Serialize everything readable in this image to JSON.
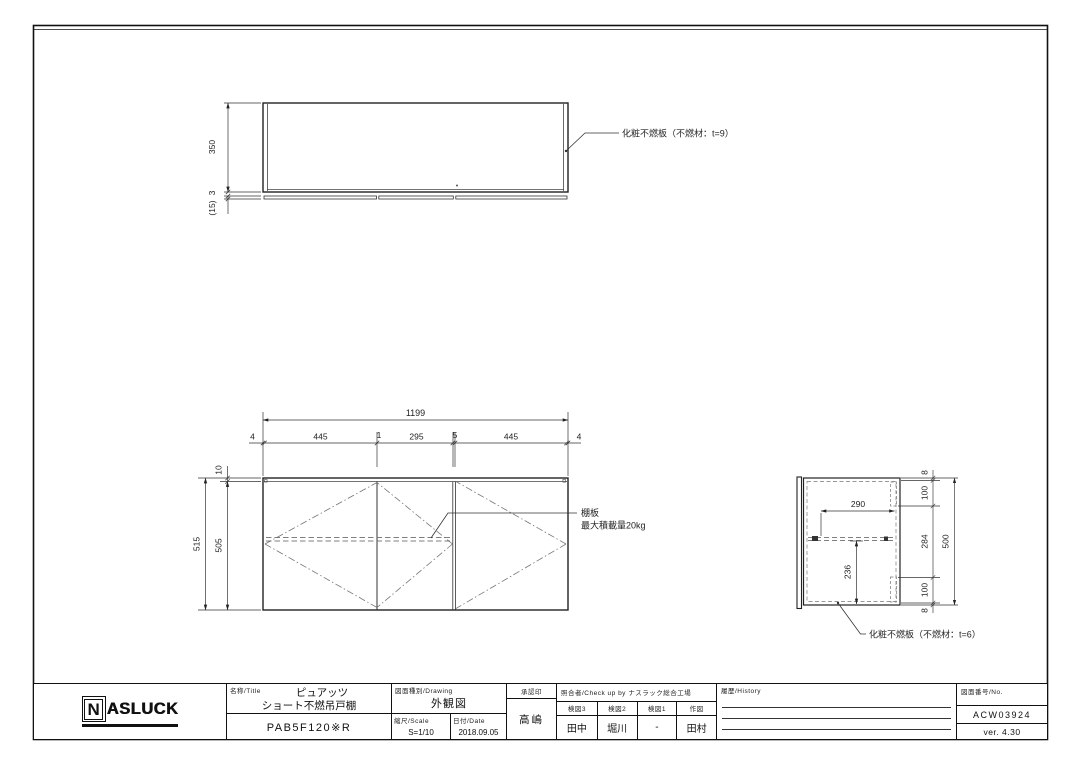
{
  "drawing": {
    "top_view": {
      "dim_height": "350",
      "dim_bottom": "3",
      "dim_offset": "(15)",
      "panel_label": "化粧不燃板（不燃材：t=9）"
    },
    "front_view": {
      "dim_total_width": "1199",
      "chain_dims": [
        "4",
        "445",
        "1",
        "295",
        "5",
        "445",
        "4"
      ],
      "dim_height_total": "515",
      "dim_height_inner": "505",
      "dim_top_panel": "10",
      "shelf_label": "棚板",
      "shelf_load_label": "最大積載量20kg"
    },
    "side_view": {
      "dim_depth": "290",
      "dim_shelf_drop": "236",
      "chain_dims": [
        "8",
        "100",
        "284",
        "100",
        "8"
      ],
      "dim_height_total": "500",
      "panel_label": "化粧不燃板（不燃材：t=6）"
    }
  },
  "title_block": {
    "logo_n": "N",
    "logo_rest": "ASLUCK",
    "name_label": "名称/Title",
    "product_series": "ピュアッツ",
    "product_type": "ショート不燃吊戸棚",
    "model_number": "PAB5F120※R",
    "drawing_label": "図面種別/Drawing",
    "drawing_type": "外観図",
    "scale_label": "縮尺/Scale",
    "scale_value": "S=1/10",
    "date_label": "日付/Date",
    "date_value": "2018.09.05",
    "approval_label": "承認印",
    "approval_name": "高嶋",
    "check_label": "照合者/Check up by ナスラック総合工場",
    "check_columns": [
      {
        "header": "検図3",
        "name": "田中"
      },
      {
        "header": "検図2",
        "name": "堀川"
      },
      {
        "header": "検図1",
        "name": "-"
      },
      {
        "header": "作図",
        "name": "田村"
      }
    ],
    "history_label": "履歴/History",
    "number_label": "図面番号/No.",
    "drawing_number": "ACW03924",
    "version": "ver. 4.30"
  }
}
